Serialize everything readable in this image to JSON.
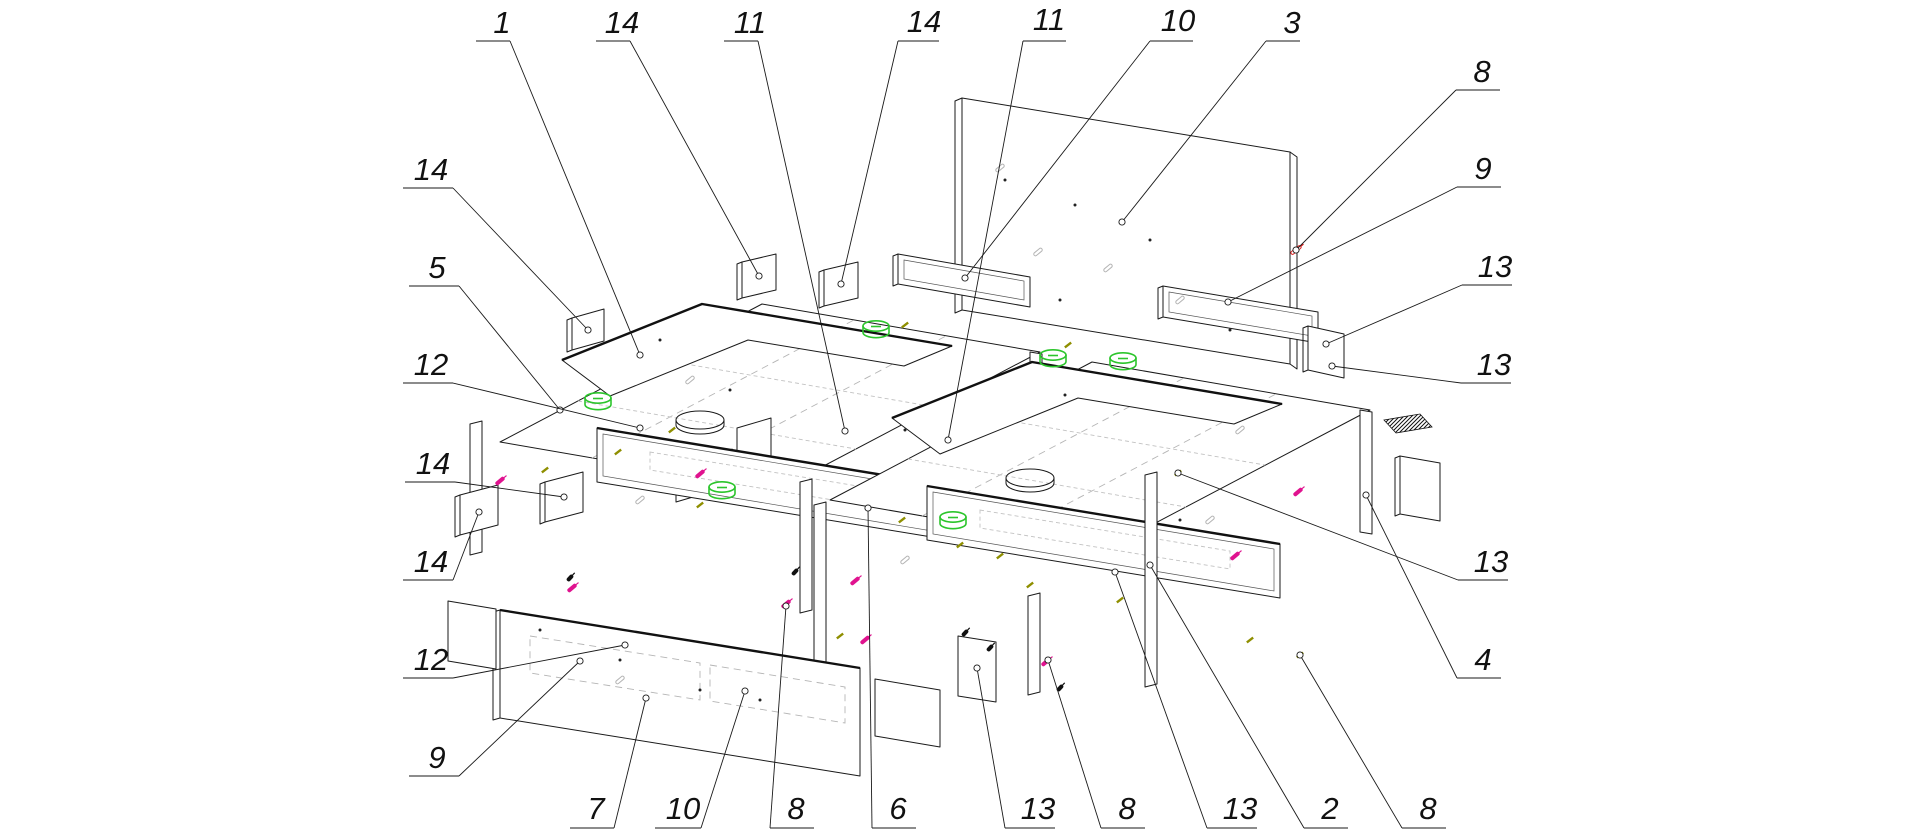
{
  "page": {
    "background": "#ffffff",
    "type": "exploded-assembly-diagram",
    "subject": "Exploded isometric assembly drawing of a storage-bed furniture unit with numbered part callouts"
  },
  "colors": {
    "line": "#1a1a1a",
    "ghost": "#b5b5b5",
    "cam_green": "#2cc52c",
    "screw_magenta": "#e0138f",
    "dowel_olive": "#8f8f00",
    "screw_red": "#d81414",
    "screw_black": "#111111"
  },
  "parts": [
    "back-panel",
    "rail-left",
    "rail-right",
    "left-box-platform",
    "left-box-top-frame",
    "left-box-front-panel",
    "right-box-platform",
    "right-box-top-frame",
    "right-box-front-panel",
    "footboard-panel",
    "footboard-left-wing",
    "footboard-right-wing",
    "mounting-cleats",
    "partition-walls",
    "hardware-kit-hatch"
  ],
  "callouts": [
    {
      "t": "1",
      "lx": 502,
      "ly": 33,
      "u": [
        476,
        510,
        41
      ],
      "p": [
        [
          510,
          41
        ],
        [
          640,
          355
        ]
      ]
    },
    {
      "t": "14",
      "lx": 622,
      "ly": 33,
      "u": [
        596,
        630,
        41
      ],
      "p": [
        [
          630,
          41
        ],
        [
          759,
          276
        ]
      ]
    },
    {
      "t": "11",
      "lx": 750,
      "ly": 33,
      "u": [
        724,
        758,
        41
      ],
      "p": [
        [
          758,
          41
        ],
        [
          845,
          431
        ]
      ]
    },
    {
      "t": "14",
      "lx": 924,
      "ly": 32,
      "u": [
        898,
        939,
        41
      ],
      "p": [
        [
          898,
          41
        ],
        [
          841,
          284
        ]
      ]
    },
    {
      "t": "11",
      "lx": 1049,
      "ly": 30,
      "u": [
        1023,
        1066,
        41
      ],
      "p": [
        [
          1023,
          41
        ],
        [
          948,
          440
        ]
      ]
    },
    {
      "t": "10",
      "lx": 1178,
      "ly": 31,
      "u": [
        1150,
        1193,
        41
      ],
      "p": [
        [
          1150,
          41
        ],
        [
          965,
          278
        ]
      ]
    },
    {
      "t": "3",
      "lx": 1292,
      "ly": 33,
      "u": [
        1266,
        1300,
        41
      ],
      "p": [
        [
          1266,
          41
        ],
        [
          1122,
          222
        ]
      ]
    },
    {
      "t": "14",
      "lx": 431,
      "ly": 180,
      "u": [
        403,
        453,
        188
      ],
      "p": [
        [
          453,
          188
        ],
        [
          588,
          330
        ]
      ]
    },
    {
      "t": "5",
      "lx": 437,
      "ly": 278,
      "u": [
        409,
        459,
        286
      ],
      "p": [
        [
          459,
          286
        ],
        [
          560,
          410
        ]
      ]
    },
    {
      "t": "12",
      "lx": 431,
      "ly": 375,
      "u": [
        403,
        453,
        383
      ],
      "p": [
        [
          453,
          383
        ],
        [
          640,
          428
        ]
      ]
    },
    {
      "t": "14",
      "lx": 433,
      "ly": 474,
      "u": [
        405,
        455,
        482
      ],
      "p": [
        [
          455,
          482
        ],
        [
          564,
          497
        ]
      ]
    },
    {
      "t": "14",
      "lx": 431,
      "ly": 572,
      "u": [
        403,
        453,
        580
      ],
      "p": [
        [
          453,
          580
        ],
        [
          479,
          512
        ]
      ]
    },
    {
      "t": "12",
      "lx": 431,
      "ly": 670,
      "u": [
        403,
        453,
        678
      ],
      "p": [
        [
          453,
          678
        ],
        [
          625,
          645
        ]
      ]
    },
    {
      "t": "9",
      "lx": 437,
      "ly": 768,
      "u": [
        409,
        459,
        776
      ],
      "p": [
        [
          459,
          776
        ],
        [
          580,
          661
        ]
      ]
    },
    {
      "t": "8",
      "lx": 1482,
      "ly": 82,
      "u": [
        1456,
        1500,
        90
      ],
      "p": [
        [
          1456,
          90
        ],
        [
          1296,
          250
        ]
      ]
    },
    {
      "t": "9",
      "lx": 1483,
      "ly": 179,
      "u": [
        1457,
        1501,
        187
      ],
      "p": [
        [
          1457,
          187
        ],
        [
          1228,
          302
        ]
      ]
    },
    {
      "t": "13",
      "lx": 1495,
      "ly": 277,
      "u": [
        1462,
        1512,
        285
      ],
      "p": [
        [
          1462,
          285
        ],
        [
          1326,
          344
        ]
      ]
    },
    {
      "t": "13",
      "lx": 1494,
      "ly": 375,
      "u": [
        1461,
        1511,
        383
      ],
      "p": [
        [
          1461,
          383
        ],
        [
          1332,
          366
        ]
      ]
    },
    {
      "t": "13",
      "lx": 1491,
      "ly": 572,
      "u": [
        1458,
        1508,
        580
      ],
      "p": [
        [
          1458,
          580
        ],
        [
          1178,
          473
        ]
      ]
    },
    {
      "t": "4",
      "lx": 1483,
      "ly": 670,
      "u": [
        1457,
        1501,
        678
      ],
      "p": [
        [
          1457,
          678
        ],
        [
          1366,
          495
        ]
      ]
    },
    {
      "t": "7",
      "lx": 596,
      "ly": 819,
      "u": [
        570,
        614,
        828
      ],
      "p": [
        [
          614,
          828
        ],
        [
          646,
          698
        ]
      ]
    },
    {
      "t": "10",
      "lx": 683,
      "ly": 819,
      "u": [
        655,
        701,
        828
      ],
      "p": [
        [
          701,
          828
        ],
        [
          745,
          691
        ]
      ]
    },
    {
      "t": "8",
      "lx": 796,
      "ly": 819,
      "u": [
        770,
        814,
        828
      ],
      "p": [
        [
          770,
          828
        ],
        [
          786,
          606
        ]
      ]
    },
    {
      "t": "6",
      "lx": 898,
      "ly": 819,
      "u": [
        872,
        916,
        828
      ],
      "p": [
        [
          872,
          828
        ],
        [
          868,
          508
        ]
      ]
    },
    {
      "t": "13",
      "lx": 1038,
      "ly": 819,
      "u": [
        1005,
        1055,
        828
      ],
      "p": [
        [
          1005,
          828
        ],
        [
          977,
          668
        ]
      ]
    },
    {
      "t": "8",
      "lx": 1127,
      "ly": 819,
      "u": [
        1101,
        1145,
        828
      ],
      "p": [
        [
          1101,
          828
        ],
        [
          1048,
          660
        ]
      ]
    },
    {
      "t": "13",
      "lx": 1240,
      "ly": 819,
      "u": [
        1207,
        1257,
        828
      ],
      "p": [
        [
          1207,
          828
        ],
        [
          1115,
          572
        ]
      ]
    },
    {
      "t": "2",
      "lx": 1330,
      "ly": 819,
      "u": [
        1304,
        1348,
        828
      ],
      "p": [
        [
          1304,
          828
        ],
        [
          1150,
          565
        ]
      ]
    },
    {
      "t": "8",
      "lx": 1428,
      "ly": 819,
      "u": [
        1402,
        1446,
        828
      ],
      "p": [
        [
          1402,
          828
        ],
        [
          1300,
          655
        ]
      ]
    }
  ],
  "hardware": {
    "cams": [
      [
        598,
        398
      ],
      [
        722,
        487
      ],
      [
        876,
        326
      ],
      [
        1053,
        355
      ],
      [
        1123,
        358
      ],
      [
        953,
        517
      ]
    ],
    "screws_magenta": [
      [
        500,
        481
      ],
      [
        572,
        588
      ],
      [
        700,
        474
      ],
      [
        786,
        604
      ],
      [
        865,
        640
      ],
      [
        1046,
        662
      ],
      [
        1235,
        556
      ],
      [
        1298,
        492
      ],
      [
        855,
        581
      ]
    ],
    "dowels_olive": [
      [
        545,
        470
      ],
      [
        618,
        452
      ],
      [
        672,
        430
      ],
      [
        700,
        505
      ],
      [
        840,
        636
      ],
      [
        902,
        520
      ],
      [
        960,
        545
      ],
      [
        1000,
        556
      ],
      [
        1120,
        600
      ],
      [
        1178,
        473
      ],
      [
        1250,
        640
      ],
      [
        1300,
        655
      ],
      [
        905,
        325
      ],
      [
        1068,
        345
      ],
      [
        1030,
        585
      ]
    ],
    "screws_black": [
      [
        570,
        578
      ],
      [
        990,
        648
      ],
      [
        1060,
        688
      ],
      [
        795,
        572
      ],
      [
        965,
        633
      ]
    ],
    "screws_red": [
      [
        1296,
        250
      ]
    ],
    "ghost_screws": [
      [
        1000,
        168
      ],
      [
        1038,
        252
      ],
      [
        1108,
        268
      ],
      [
        1180,
        300
      ],
      [
        640,
        500
      ],
      [
        905,
        560
      ],
      [
        1240,
        430
      ],
      [
        690,
        380
      ],
      [
        1210,
        520
      ],
      [
        620,
        680
      ]
    ],
    "dots": [
      [
        1005,
        180
      ],
      [
        1075,
        205
      ],
      [
        1150,
        240
      ],
      [
        1060,
        300
      ],
      [
        660,
        340
      ],
      [
        730,
        390
      ],
      [
        905,
        430
      ],
      [
        1065,
        395
      ],
      [
        620,
        660
      ],
      [
        700,
        690
      ],
      [
        760,
        700
      ],
      [
        1180,
        520
      ],
      [
        1230,
        330
      ],
      [
        540,
        630
      ]
    ],
    "ovals": [
      [
        700,
        420
      ],
      [
        1030,
        478
      ]
    ]
  }
}
